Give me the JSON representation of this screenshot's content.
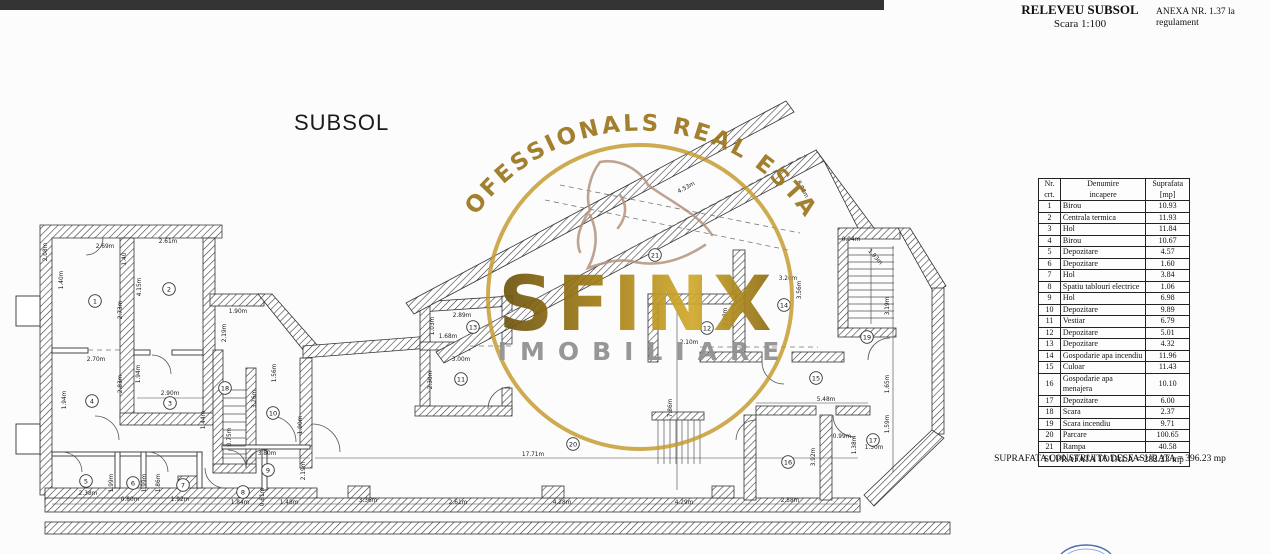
{
  "header": {
    "title": "RELEVEU SUBSOL",
    "scale": "Scara 1:100",
    "annex": "ANEXA NR. 1.37 la regulament"
  },
  "plan": {
    "label": "SUBSOL"
  },
  "watermark": {
    "arc_text": "PROFESSIONALS REAL ESTATE",
    "name": "SFINX",
    "subtitle": "IMOBILIARE",
    "gold": "#9c761c",
    "gray": "#8f8f8f",
    "tan": "#b3917a",
    "ring": "#c49a2e"
  },
  "stamp_color": "#4a6fae",
  "table": {
    "headers": {
      "c1a": "Nr.",
      "c1b": "crt.",
      "c2a": "Denumire",
      "c2b": "incapere",
      "c3a": "Suprafata",
      "c3b": "[mp]"
    },
    "rows": [
      [
        "1",
        "Birou",
        "10.93"
      ],
      [
        "2",
        "Centrala termica",
        "11.93"
      ],
      [
        "3",
        "Hol",
        "11.84"
      ],
      [
        "4",
        "Birou",
        "10.67"
      ],
      [
        "5",
        "Depozitare",
        "4.57"
      ],
      [
        "6",
        "Depozitare",
        "1.60"
      ],
      [
        "7",
        "Hol",
        "3.84"
      ],
      [
        "8",
        "Spatiu tablouri electrice",
        "1.06"
      ],
      [
        "9",
        "Hol",
        "6.98"
      ],
      [
        "10",
        "Depozitare",
        "9.89"
      ],
      [
        "11",
        "Vestiar",
        "6.79"
      ],
      [
        "12",
        "Depozitare",
        "5.01"
      ],
      [
        "13",
        "Depozitare",
        "4.32"
      ],
      [
        "14",
        "Gospodarie apa incendiu",
        "11.96"
      ],
      [
        "15",
        "Culoar",
        "11.43"
      ],
      [
        "16",
        "Gospodarie apa menajera",
        "10.10"
      ],
      [
        "17",
        "Depozitare",
        "6.00"
      ],
      [
        "18",
        "Scara",
        "2.37"
      ],
      [
        "19",
        "Scara incendiu",
        "9.71"
      ],
      [
        "20",
        "Parcare",
        "100.65"
      ],
      [
        "21",
        "Rampa",
        "40.58"
      ]
    ],
    "total": "SUPRAFATA TOTALA = 282.23 mp"
  },
  "footer": {
    "built_area": "SUPRAFATA CONSTRUITA DESFASURATA = 396.23 mp"
  },
  "rooms": [
    {
      "n": "1",
      "x": 95,
      "y": 301
    },
    {
      "n": "2",
      "x": 169,
      "y": 289
    },
    {
      "n": "3",
      "x": 170,
      "y": 403
    },
    {
      "n": "4",
      "x": 92,
      "y": 401
    },
    {
      "n": "5",
      "x": 86,
      "y": 481
    },
    {
      "n": "6",
      "x": 133,
      "y": 483
    },
    {
      "n": "7",
      "x": 183,
      "y": 485
    },
    {
      "n": "8",
      "x": 243,
      "y": 492
    },
    {
      "n": "9",
      "x": 268,
      "y": 470
    },
    {
      "n": "10",
      "x": 273,
      "y": 413
    },
    {
      "n": "11",
      "x": 461,
      "y": 379
    },
    {
      "n": "12",
      "x": 707,
      "y": 328
    },
    {
      "n": "13",
      "x": 473,
      "y": 327
    },
    {
      "n": "14",
      "x": 784,
      "y": 305
    },
    {
      "n": "15",
      "x": 816,
      "y": 378
    },
    {
      "n": "16",
      "x": 788,
      "y": 462
    },
    {
      "n": "17",
      "x": 873,
      "y": 440
    },
    {
      "n": "18",
      "x": 225,
      "y": 388
    },
    {
      "n": "19",
      "x": 867,
      "y": 337
    },
    {
      "n": "20",
      "x": 573,
      "y": 444
    },
    {
      "n": "21",
      "x": 655,
      "y": 255
    }
  ],
  "dims": [
    {
      "t": "2.69m",
      "x": 105,
      "y": 248
    },
    {
      "t": "2.61m",
      "x": 168,
      "y": 243
    },
    {
      "t": "2.08m",
      "x": 47,
      "y": 252,
      "r": -90
    },
    {
      "t": "1.40m",
      "x": 63,
      "y": 280,
      "r": -90
    },
    {
      "t": "1.40",
      "x": 126,
      "y": 259,
      "r": -90
    },
    {
      "t": "4.15m",
      "x": 141,
      "y": 287,
      "r": -90
    },
    {
      "t": "2.73m",
      "x": 122,
      "y": 310,
      "r": -90
    },
    {
      "t": "1.90m",
      "x": 238,
      "y": 313
    },
    {
      "t": "2.19m",
      "x": 226,
      "y": 333,
      "r": -90
    },
    {
      "t": "2.70m",
      "x": 96,
      "y": 361
    },
    {
      "t": "1.94m",
      "x": 66,
      "y": 400,
      "r": -90
    },
    {
      "t": "1.94m",
      "x": 140,
      "y": 374,
      "r": -90
    },
    {
      "t": "2.83m",
      "x": 122,
      "y": 384,
      "r": -90
    },
    {
      "t": "2.90m",
      "x": 170,
      "y": 395
    },
    {
      "t": "1.44m",
      "x": 205,
      "y": 420,
      "r": -90
    },
    {
      "t": "1.56m",
      "x": 276,
      "y": 373,
      "r": -90
    },
    {
      "t": "3.26m",
      "x": 256,
      "y": 399,
      "r": -90
    },
    {
      "t": "1.90m",
      "x": 302,
      "y": 425,
      "r": -90
    },
    {
      "t": "0.75m",
      "x": 231,
      "y": 437,
      "r": -90
    },
    {
      "t": "2.38m",
      "x": 88,
      "y": 495
    },
    {
      "t": "1.99m",
      "x": 113,
      "y": 483,
      "r": -90
    },
    {
      "t": "0.80m",
      "x": 130,
      "y": 501
    },
    {
      "t": "1.99m",
      "x": 146,
      "y": 483,
      "r": -90
    },
    {
      "t": "1.86m",
      "x": 160,
      "y": 483,
      "r": -90
    },
    {
      "t": "1.92m",
      "x": 180,
      "y": 501
    },
    {
      "t": "1.84m",
      "x": 240,
      "y": 504
    },
    {
      "t": "0.61m",
      "x": 264,
      "y": 497,
      "r": -90
    },
    {
      "t": "1.48m",
      "x": 289,
      "y": 504
    },
    {
      "t": "3.36m",
      "x": 368,
      "y": 502
    },
    {
      "t": "3.80m",
      "x": 267,
      "y": 455
    },
    {
      "t": "2.19m",
      "x": 305,
      "y": 471,
      "r": -90
    },
    {
      "t": "2.61m",
      "x": 458,
      "y": 504
    },
    {
      "t": "4.28m",
      "x": 562,
      "y": 504
    },
    {
      "t": "4.29m",
      "x": 684,
      "y": 504
    },
    {
      "t": "2.58m",
      "x": 790,
      "y": 502
    },
    {
      "t": "17.71m",
      "x": 533,
      "y": 456
    },
    {
      "t": "7.86m",
      "x": 672,
      "y": 408,
      "r": -90
    },
    {
      "t": "1.03m",
      "x": 434,
      "y": 326,
      "r": -90
    },
    {
      "t": "2.89m",
      "x": 462,
      "y": 317
    },
    {
      "t": "1.68m",
      "x": 448,
      "y": 338
    },
    {
      "t": "3.00m",
      "x": 461,
      "y": 361
    },
    {
      "t": "2.30m",
      "x": 432,
      "y": 380,
      "r": -90
    },
    {
      "t": "2.10m",
      "x": 689,
      "y": 344
    },
    {
      "t": "2.28m",
      "x": 727,
      "y": 317,
      "r": -90
    },
    {
      "t": "3.20m",
      "x": 788,
      "y": 280
    },
    {
      "t": "3.56m",
      "x": 801,
      "y": 290,
      "r": -90
    },
    {
      "t": "0.94m",
      "x": 851,
      "y": 241
    },
    {
      "t": "1.93m",
      "x": 874,
      "y": 258,
      "r": 48
    },
    {
      "t": "3.19m",
      "x": 889,
      "y": 306,
      "r": -90
    },
    {
      "t": "1.65m",
      "x": 889,
      "y": 384,
      "r": -90
    },
    {
      "t": "5.48m",
      "x": 826,
      "y": 401
    },
    {
      "t": "1.59m",
      "x": 889,
      "y": 424,
      "r": -90
    },
    {
      "t": "0.99m",
      "x": 842,
      "y": 438
    },
    {
      "t": "1.38m",
      "x": 856,
      "y": 445,
      "r": -90
    },
    {
      "t": "1.50m",
      "x": 874,
      "y": 449
    },
    {
      "t": "3.92m",
      "x": 815,
      "y": 457,
      "r": -90
    },
    {
      "t": "4.53m",
      "x": 687,
      "y": 189,
      "r": -28
    },
    {
      "t": "8.96m",
      "x": 801,
      "y": 190,
      "r": 62
    }
  ]
}
